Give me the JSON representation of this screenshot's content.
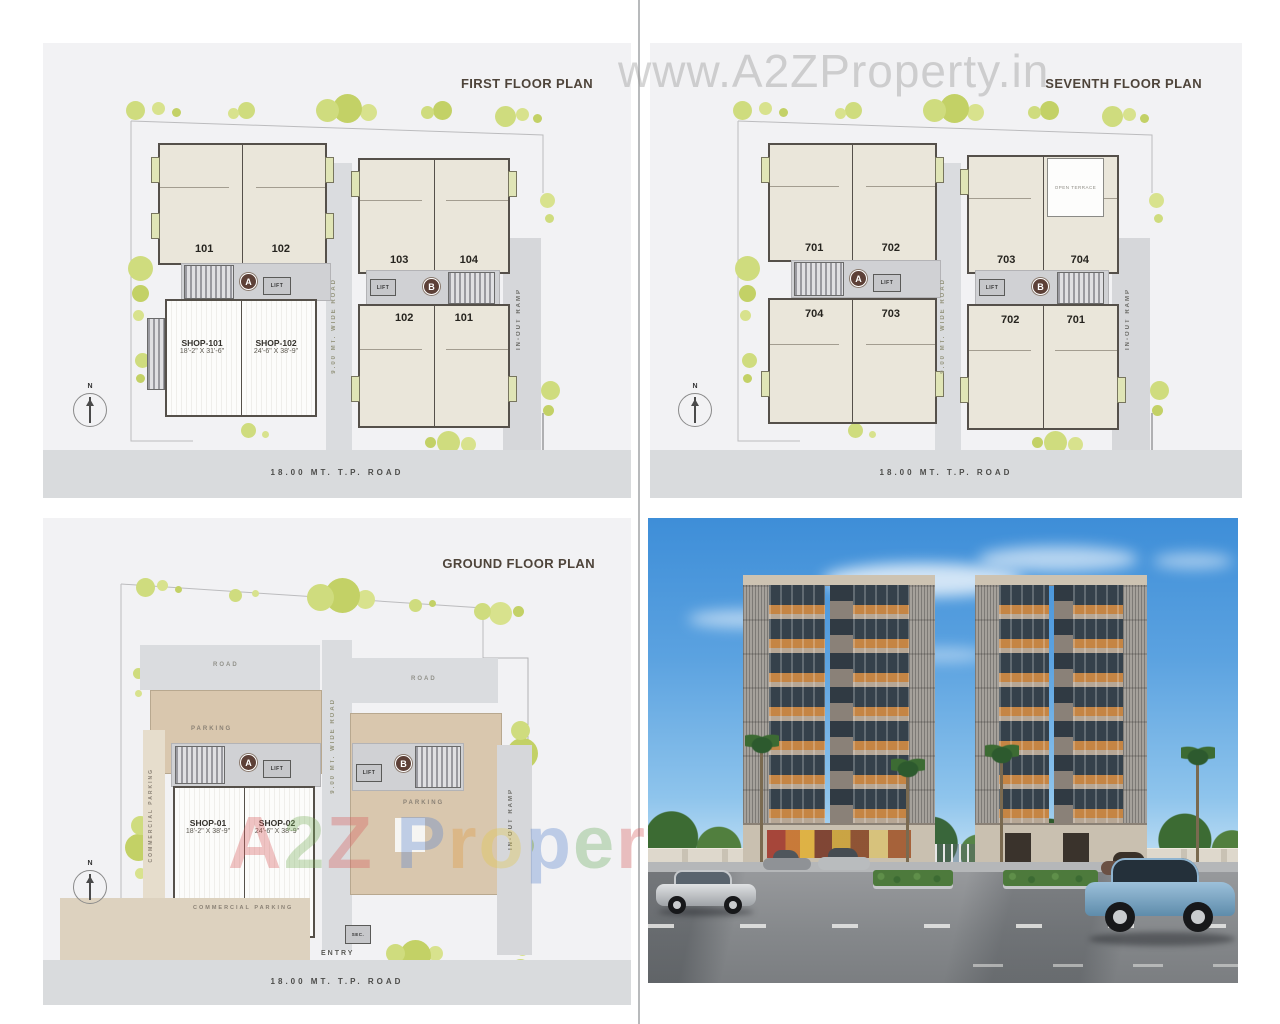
{
  "colors": {
    "plan_bg": "#f2f2f4",
    "plan_wall": "#55504a",
    "unit_fill": "#eae6da",
    "balcony_green": "#e0e5b6",
    "tree_green": "#cfdc7e",
    "road_band": "#d9dbdd",
    "parking_tan": "#d9c7ae",
    "title_brown": "#4e443a",
    "marker_brown": "#5d4037",
    "sky_blue": "#3e8ed8",
    "balcony_orange": "#c58544",
    "facade_beige": "#b7a795"
  },
  "watermark_top": "www.A2ZProperty.in",
  "watermark_bottom_letters": [
    {
      "ch": "A",
      "style": "color:#d85c5c"
    },
    {
      "ch": "2",
      "style": "color:#7ab05c"
    },
    {
      "ch": "Z",
      "style": "color:#d85c5c"
    },
    {
      "ch": " ",
      "style": "color:#888888"
    },
    {
      "ch": "P",
      "style": "color:#5b85cf"
    },
    {
      "ch": "r",
      "style": "color:#e09a40"
    },
    {
      "ch": "o",
      "style": "color:#e3c84a"
    },
    {
      "ch": "p",
      "style": "color:#5b85cf"
    },
    {
      "ch": "e",
      "style": "color:#6cab5e"
    },
    {
      "ch": "r",
      "style": "color:#d85c5c"
    },
    {
      "ch": "t",
      "style": "color:#5b85cf"
    },
    {
      "ch": "y",
      "style": "color:#e09a40"
    }
  ],
  "first_floor": {
    "title": "FIRST FLOOR PLAN",
    "marker_a": "A",
    "marker_b": "B",
    "lift": "LIFT",
    "a_units": [
      "101",
      "102"
    ],
    "shop1_name": "SHOP-101",
    "shop1_dim": "18'-2\" X 31'-6\"",
    "shop2_name": "SHOP-102",
    "shop2_dim": "24'-6\" X 38'-9\"",
    "b_units_top": [
      "103",
      "104"
    ],
    "b_units_bottom": [
      "102",
      "101"
    ],
    "wide_road": "9.00 MT. WIDE ROAD",
    "ramp": "IN-OUT RAMP",
    "tp_road": "18.00 MT. T.P. ROAD",
    "north": "N"
  },
  "seventh_floor": {
    "title": "SEVENTH FLOOR PLAN",
    "marker_a": "A",
    "marker_b": "B",
    "lift": "LIFT",
    "a_units_top": [
      "701",
      "702"
    ],
    "a_units_bottom": [
      "704",
      "703"
    ],
    "b_units_top": [
      "703",
      "704"
    ],
    "b_units_bottom": [
      "702",
      "701"
    ],
    "open_terrace": "OPEN TERRACE",
    "wide_road": "9.00 MT. WIDE ROAD",
    "ramp": "IN-OUT RAMP",
    "tp_road": "18.00 MT. T.P. ROAD",
    "north": "N"
  },
  "ground_floor": {
    "title": "GROUND FLOOR PLAN",
    "marker_a": "A",
    "marker_b": "B",
    "lift": "LIFT",
    "road_left": "ROAD",
    "road_right": "ROAD",
    "parking_a": "PARKING",
    "parking_b": "PARKING",
    "commercial_parking_side": "COMMERCIAL PARKING",
    "commercial_parking_bottom": "COMMERCIAL PARKING",
    "shop1_name": "SHOP-01",
    "shop1_dim": "18'-2\" X 38'-9\"",
    "shop2_name": "SHOP-02",
    "shop2_dim": "24'-6\" X 38'-9\"",
    "entry": "ENTRY",
    "security": "SEC.",
    "wide_road": "9.00 MT. WIDE ROAD",
    "ramp": "IN-OUT RAMP",
    "tp_road": "18.00 MT. T.P. ROAD",
    "north": "N"
  }
}
